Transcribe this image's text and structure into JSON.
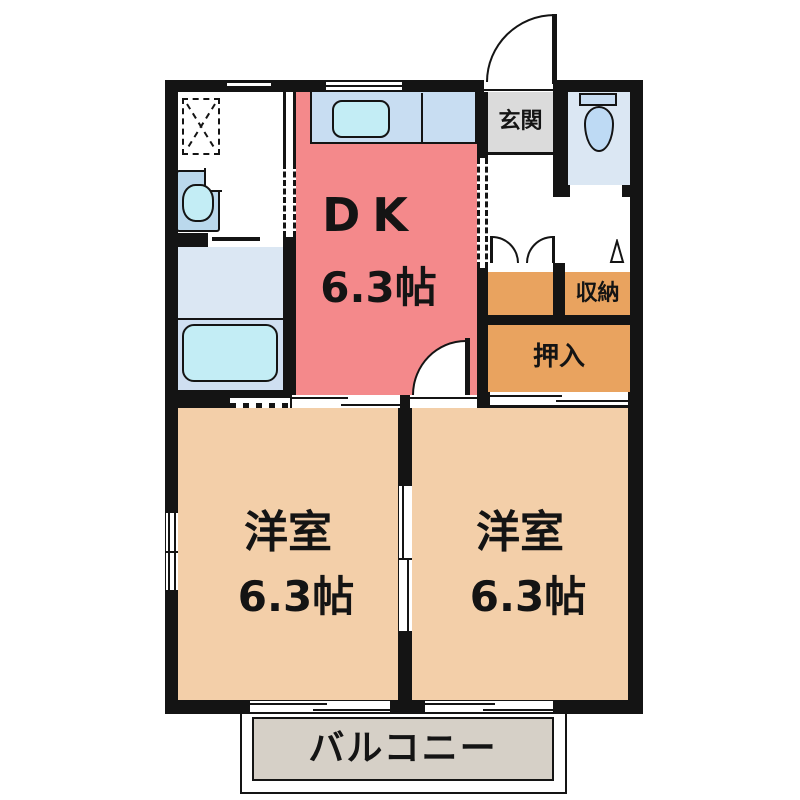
{
  "plan": {
    "rooms": {
      "dk": {
        "label": "DK",
        "size": "6.3帖"
      },
      "western_left": {
        "label": "洋室",
        "size": "6.3帖"
      },
      "western_right": {
        "label": "洋室",
        "size": "6.3帖"
      },
      "entrance": {
        "label": "玄関"
      },
      "storage": {
        "label": "収納"
      },
      "futon_closet": {
        "label": "押入"
      },
      "balcony": {
        "label": "バルコニー"
      }
    },
    "fixtures": [
      "kitchen-sink",
      "bathtub",
      "washbasin",
      "washing-machine-pan",
      "toilet"
    ],
    "colors": {
      "wall": "#141414",
      "dk_room": "#f4898b",
      "western_room": "#f3cfa9",
      "closet": "#e9a35f",
      "entrance": "#dbdbdb",
      "balcony": "#d6d0c7",
      "wet_area_floor": "#dbe7f3",
      "fixture_blue": "#c3edf5",
      "kitchen_counter": "#c8ddf2",
      "toilet_bowl": "#bedaf4"
    }
  }
}
